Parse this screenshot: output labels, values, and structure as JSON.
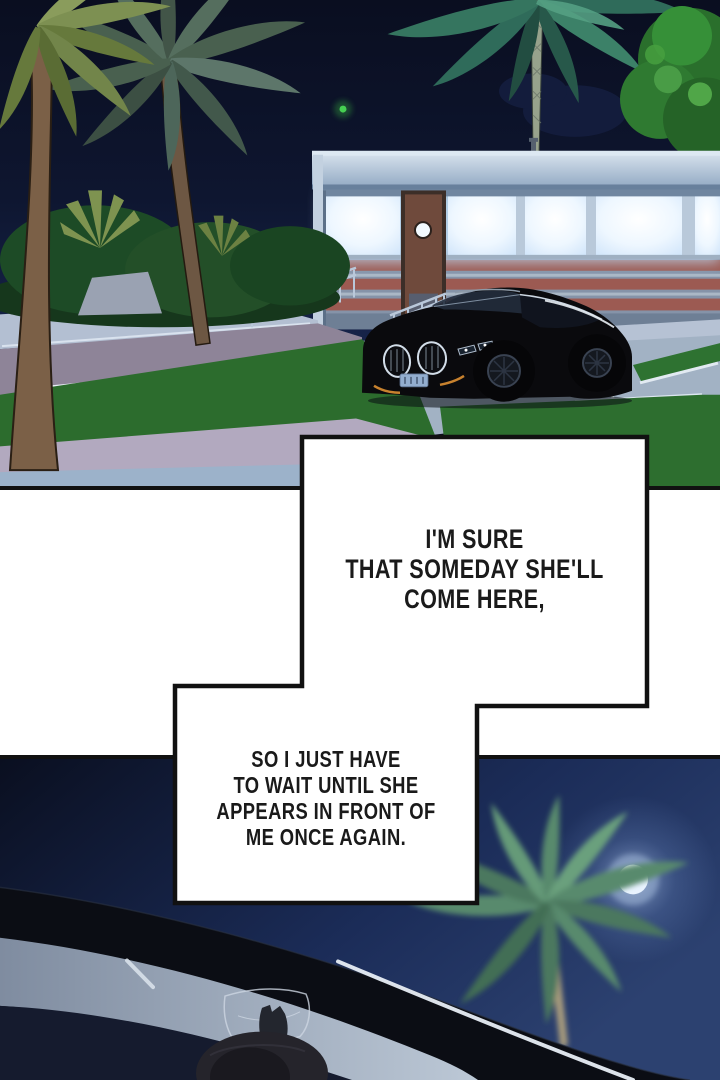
{
  "page": {
    "kind": "comic page",
    "panel_count": 2,
    "narration": {
      "box1": {
        "lines": [
          "I'M SURE",
          "THAT SOMEDAY SHE'LL",
          "COME HERE,"
        ]
      },
      "box2": {
        "lines": [
          "SO I JUST HAVE",
          "TO WAIT UNTIL SHE",
          "APPEARS IN FRONT OF",
          "ME ONCE AGAIN."
        ]
      }
    },
    "scene_top_elements": [
      "night-sky",
      "palm-trees",
      "lit-diner-building",
      "black-sedan",
      "parking-lot",
      "lawn",
      "railings",
      "green-signal-light"
    ],
    "scene_bottom_elements": [
      "night-sky",
      "moon",
      "palm-tree",
      "car-windshield-foreground",
      "driver-silhouette"
    ],
    "colors": {
      "panel_border": "#111111",
      "gutter": "#ffffff",
      "sky_top_panel": "#0c1226",
      "sky_bottom_panel": "#1b2c58",
      "moon": "#e9f3ff",
      "lawn_green": "#2d6e2f",
      "road_purple": "#8e8498",
      "pavement": "#a2b2c4",
      "building_stripe_red": "#9c5a52",
      "window_glow": "#eef7ff",
      "car_black": "#0a0a0d",
      "pillar_gray": "#9aa7ba",
      "palm_green_bottom": "#588a6d",
      "text": "#1a1a1a"
    }
  }
}
